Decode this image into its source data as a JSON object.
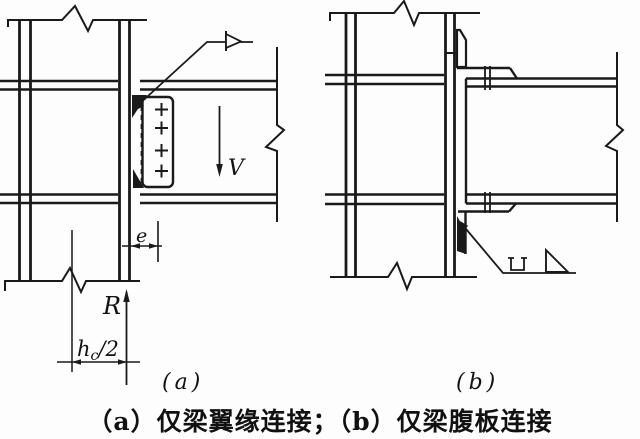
{
  "figure": {
    "caption": "（a）仅梁翼缘连接；（b）仅梁腹板连接",
    "panels": [
      {
        "id": "a",
        "label": "(a)",
        "description": "仅梁翼缘连接"
      },
      {
        "id": "b",
        "label": "(b)",
        "description": "仅梁腹板连接"
      }
    ],
    "annotations": {
      "shear_force": "V",
      "reaction": "R",
      "eccentricity": "e",
      "half_column_depth_main": "h",
      "half_column_depth_sub": "c",
      "half_column_depth_rest": "/2"
    },
    "symbols": {
      "field_weld_flag": "field-weld-flag-icon",
      "fillet_weld": "fillet-weld-triangle-icon",
      "u_groove_weld": "u-groove-weld-icon",
      "bolt_marks": "bolt-cross-icon",
      "break_line": "break-zigzag-icon"
    },
    "colors": {
      "line": "#1a1a1a",
      "background": "#fdfdfd"
    }
  }
}
